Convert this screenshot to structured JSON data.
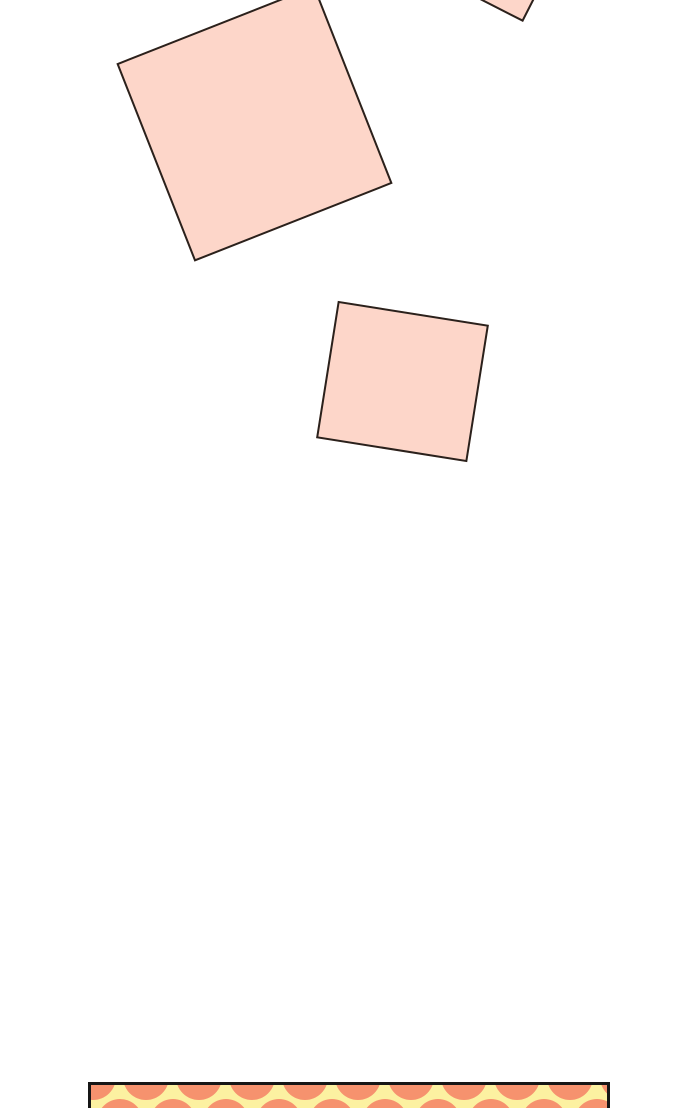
{
  "page": {
    "width": 700,
    "height": 1108,
    "background": "#ffffff"
  },
  "artwork": {
    "note_fill": "#fdd6c9",
    "note_border": "#2a211c",
    "note_border_width": 2,
    "notes": [
      {
        "id": "sticky-note-corner",
        "left": 444,
        "top": -107,
        "width": 110,
        "height": 110,
        "rotate": 27
      },
      {
        "id": "sticky-note-large",
        "left": 148,
        "top": 17,
        "width": 213,
        "height": 213,
        "rotate": -21.5
      },
      {
        "id": "sticky-note-medium",
        "left": 326,
        "top": 312,
        "width": 153,
        "height": 139,
        "rotate": 9
      }
    ],
    "dotted_panel": {
      "left": 88,
      "top": 1082,
      "width": 522,
      "height": 60,
      "border_color": "#161616",
      "border_width": 3,
      "bg": "#fcf1a1",
      "dot_color": "#f6926e",
      "dot_radius": 23,
      "dot_spacing_x": 53,
      "rows": [
        {
          "y": -8,
          "x_start": 2
        },
        {
          "y": 37,
          "x_start": 28.5
        }
      ]
    }
  }
}
